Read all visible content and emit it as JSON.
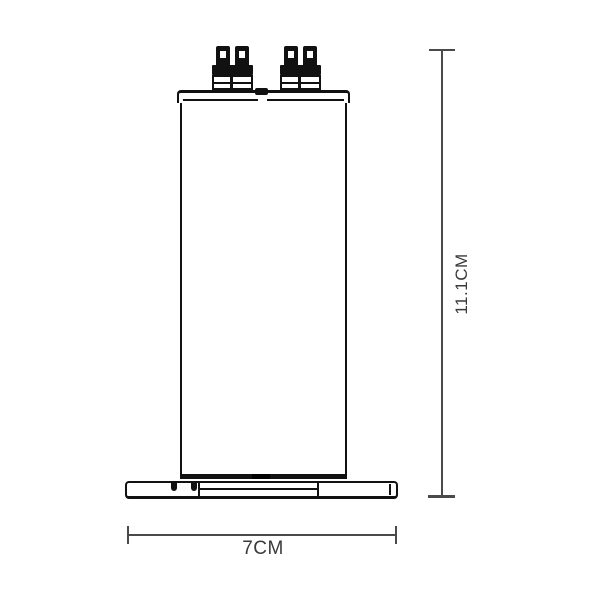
{
  "figure": {
    "kind": "technical-drawing",
    "height_dimension": {
      "label": "11.1CM"
    },
    "width_dimension": {
      "label": "7CM"
    }
  },
  "colors": {
    "background": "#ffffff",
    "part_line": "#111111",
    "dimension_line": "#4a4a4a",
    "dimension_text": "#3a3a3a"
  }
}
